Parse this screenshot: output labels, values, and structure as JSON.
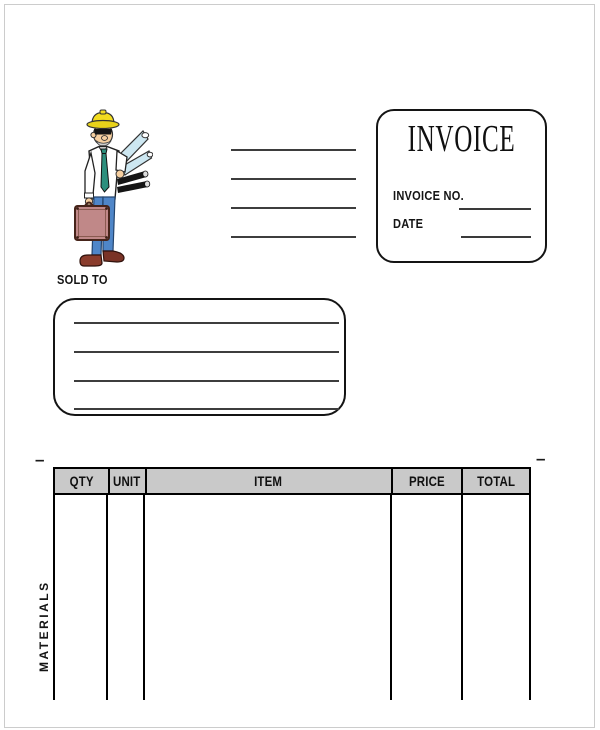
{
  "page": {
    "bg": "#ffffff",
    "frame_color": "#cccccc"
  },
  "header": {
    "company_line_count": 4,
    "invoice_box": {
      "title": "INVOICE",
      "fields": [
        {
          "label": "INVOICE NO."
        },
        {
          "label": "DATE"
        }
      ]
    }
  },
  "sold_to": {
    "label": "SOLD TO",
    "line_count": 4
  },
  "marks": {
    "left_dash": "–",
    "right_dash": "–"
  },
  "items_table": {
    "headers": [
      "QTY",
      "UNIT",
      "ITEM",
      "PRICE",
      "TOTAL"
    ],
    "header_bg": "#c9c9c9",
    "border_color": "#000000",
    "section_label": "MATERIALS",
    "rows": []
  },
  "illustration": {
    "description": "construction worker with hard hat carrying blueprints and briefcase",
    "colors": {
      "hat": "#f2dc1f",
      "skin": "#f6cfa0",
      "tie": "#2c8f7d",
      "blueprints": "#cde7f1",
      "pants": "#4f86c8",
      "briefcase": "#c08888",
      "shoes": "#8a3c2c"
    }
  }
}
